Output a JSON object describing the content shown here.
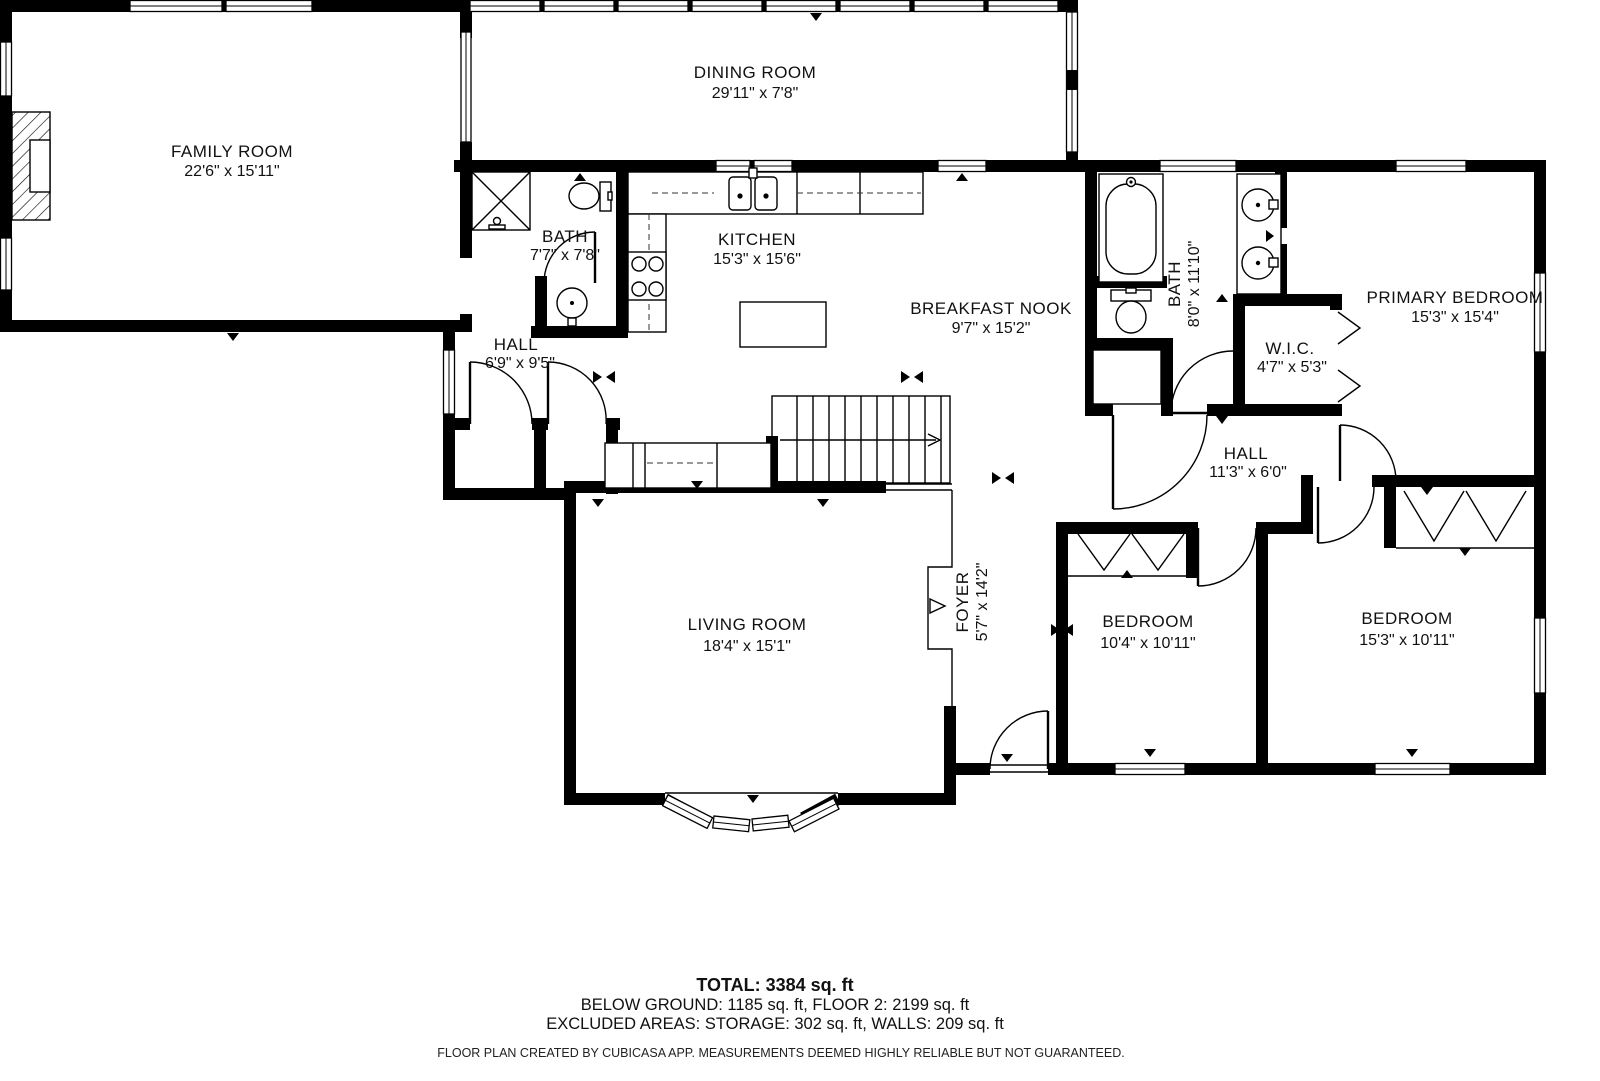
{
  "page": {
    "background": "#ffffff",
    "wall_color": "#000000",
    "text_color": "#111111",
    "type": "floor-plan"
  },
  "rooms": {
    "family_room": {
      "name": "FAMILY ROOM",
      "dims": "22'6\" x 15'11\""
    },
    "dining_room": {
      "name": "DINING ROOM",
      "dims": "29'11\" x 7'8\""
    },
    "bath_main": {
      "name": "BATH",
      "dims": "7'7\" x 7'8\""
    },
    "kitchen": {
      "name": "KITCHEN",
      "dims": "15'3\" x 15'6\""
    },
    "hall_lower": {
      "name": "HALL",
      "dims": "6'9\" x 9'5\""
    },
    "breakfast_nook": {
      "name": "BREAKFAST NOOK",
      "dims": "9'7\" x 15'2\""
    },
    "bath_primary": {
      "name": "BATH",
      "dims": "8'0\" x 11'10\""
    },
    "wic": {
      "name": "W.I.C.",
      "dims": "4'7\" x 5'3\""
    },
    "primary_bedroom": {
      "name": "PRIMARY BEDROOM",
      "dims": "15'3\" x 15'4\""
    },
    "hall_bedroom": {
      "name": "HALL",
      "dims": "11'3\" x 6'0\""
    },
    "living_room": {
      "name": "LIVING ROOM",
      "dims": "18'4\" x 15'1\""
    },
    "foyer": {
      "name": "FOYER",
      "dims": "5'7\" x 14'2\""
    },
    "bedroom_small": {
      "name": "BEDROOM",
      "dims": "10'4\" x 10'11\""
    },
    "bedroom_large": {
      "name": "BEDROOM",
      "dims": "15'3\" x 10'11\""
    }
  },
  "summary": {
    "total": "TOTAL: 3384 sq. ft",
    "breakdown": "BELOW GROUND: 1185 sq. ft, FLOOR 2: 2199 sq. ft",
    "excluded": "EXCLUDED AREAS: STORAGE: 302 sq. ft, WALLS: 209 sq. ft"
  },
  "footer": {
    "disclaimer": "FLOOR PLAN CREATED BY CUBICASA APP. MEASUREMENTS DEEMED HIGHLY RELIABLE BUT NOT GUARANTEED."
  }
}
